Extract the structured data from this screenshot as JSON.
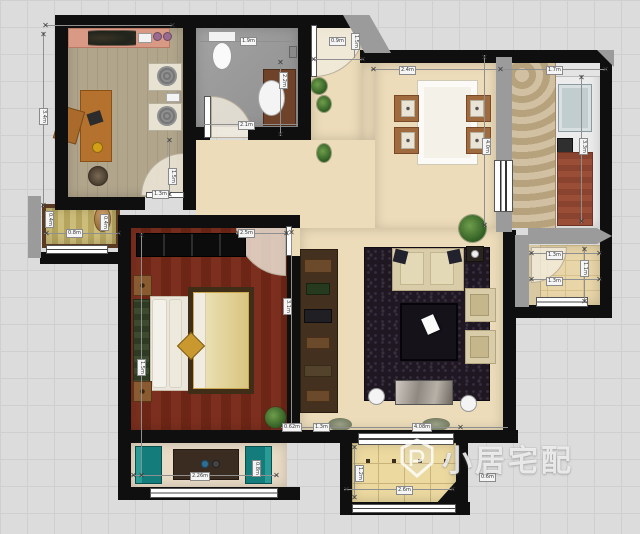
{
  "watermark": {
    "text": "小居宅配"
  },
  "colors": {
    "background": "#dcdcdc",
    "wall": "#0f0f0f",
    "secondary_wall": "#9b9b9b",
    "main_floor": "#ecdcba",
    "study_floor": "#aea27f",
    "bedroom_floor": "#772f1c",
    "bathroom_floor": "#9b9b9b",
    "balcony_tile": "#ead79f",
    "living_rug": "#1f1823",
    "teal_chair": "#157c7c",
    "kitchen_counter": "#9a4e38",
    "bed_quilt": "#ddc98c"
  },
  "dimension_labels": [
    {
      "text": "0.9m",
      "x": 329,
      "y": 37,
      "v": false
    },
    {
      "text": "1.5m",
      "x": 351,
      "y": 33,
      "v": true
    },
    {
      "text": "2.4m",
      "x": 399,
      "y": 66,
      "v": false
    },
    {
      "text": "1.7m",
      "x": 546,
      "y": 66,
      "v": false
    },
    {
      "text": "1.9m",
      "x": 240,
      "y": 37,
      "v": false
    },
    {
      "text": "2.1m",
      "x": 238,
      "y": 121,
      "v": false
    },
    {
      "text": "2.2m",
      "x": 279,
      "y": 72,
      "v": true
    },
    {
      "text": "3.4m",
      "x": 39,
      "y": 108,
      "v": true
    },
    {
      "text": "1.3m",
      "x": 152,
      "y": 190,
      "v": false
    },
    {
      "text": "1.5m",
      "x": 168,
      "y": 168,
      "v": true
    },
    {
      "text": "0.8m",
      "x": 66,
      "y": 229,
      "v": false
    },
    {
      "text": "0.4m",
      "x": 45,
      "y": 211,
      "v": true
    },
    {
      "text": "0.4m",
      "x": 100,
      "y": 214,
      "v": true
    },
    {
      "text": "2.5m",
      "x": 238,
      "y": 229,
      "v": false
    },
    {
      "text": "3.1m",
      "x": 283,
      "y": 298,
      "v": true
    },
    {
      "text": "1.5m",
      "x": 137,
      "y": 359,
      "v": true
    },
    {
      "text": "2.26m",
      "x": 190,
      "y": 472,
      "v": false
    },
    {
      "text": "0.8m",
      "x": 252,
      "y": 460,
      "v": true
    },
    {
      "text": "0.62m",
      "x": 282,
      "y": 423,
      "v": false
    },
    {
      "text": "1.3m",
      "x": 313,
      "y": 423,
      "v": false
    },
    {
      "text": "4.08m",
      "x": 412,
      "y": 423,
      "v": false
    },
    {
      "text": "4.0m",
      "x": 482,
      "y": 138,
      "v": true
    },
    {
      "text": "1.3m",
      "x": 546,
      "y": 251,
      "v": false
    },
    {
      "text": "1.3m",
      "x": 546,
      "y": 277,
      "v": false
    },
    {
      "text": "1.1m",
      "x": 580,
      "y": 260,
      "v": true
    },
    {
      "text": "1.2m",
      "x": 355,
      "y": 465,
      "v": true
    },
    {
      "text": "2.6m",
      "x": 396,
      "y": 486,
      "v": false
    },
    {
      "text": "0.6m",
      "x": 479,
      "y": 473,
      "v": false
    },
    {
      "text": "3.3m",
      "x": 579,
      "y": 138,
      "v": true
    }
  ]
}
